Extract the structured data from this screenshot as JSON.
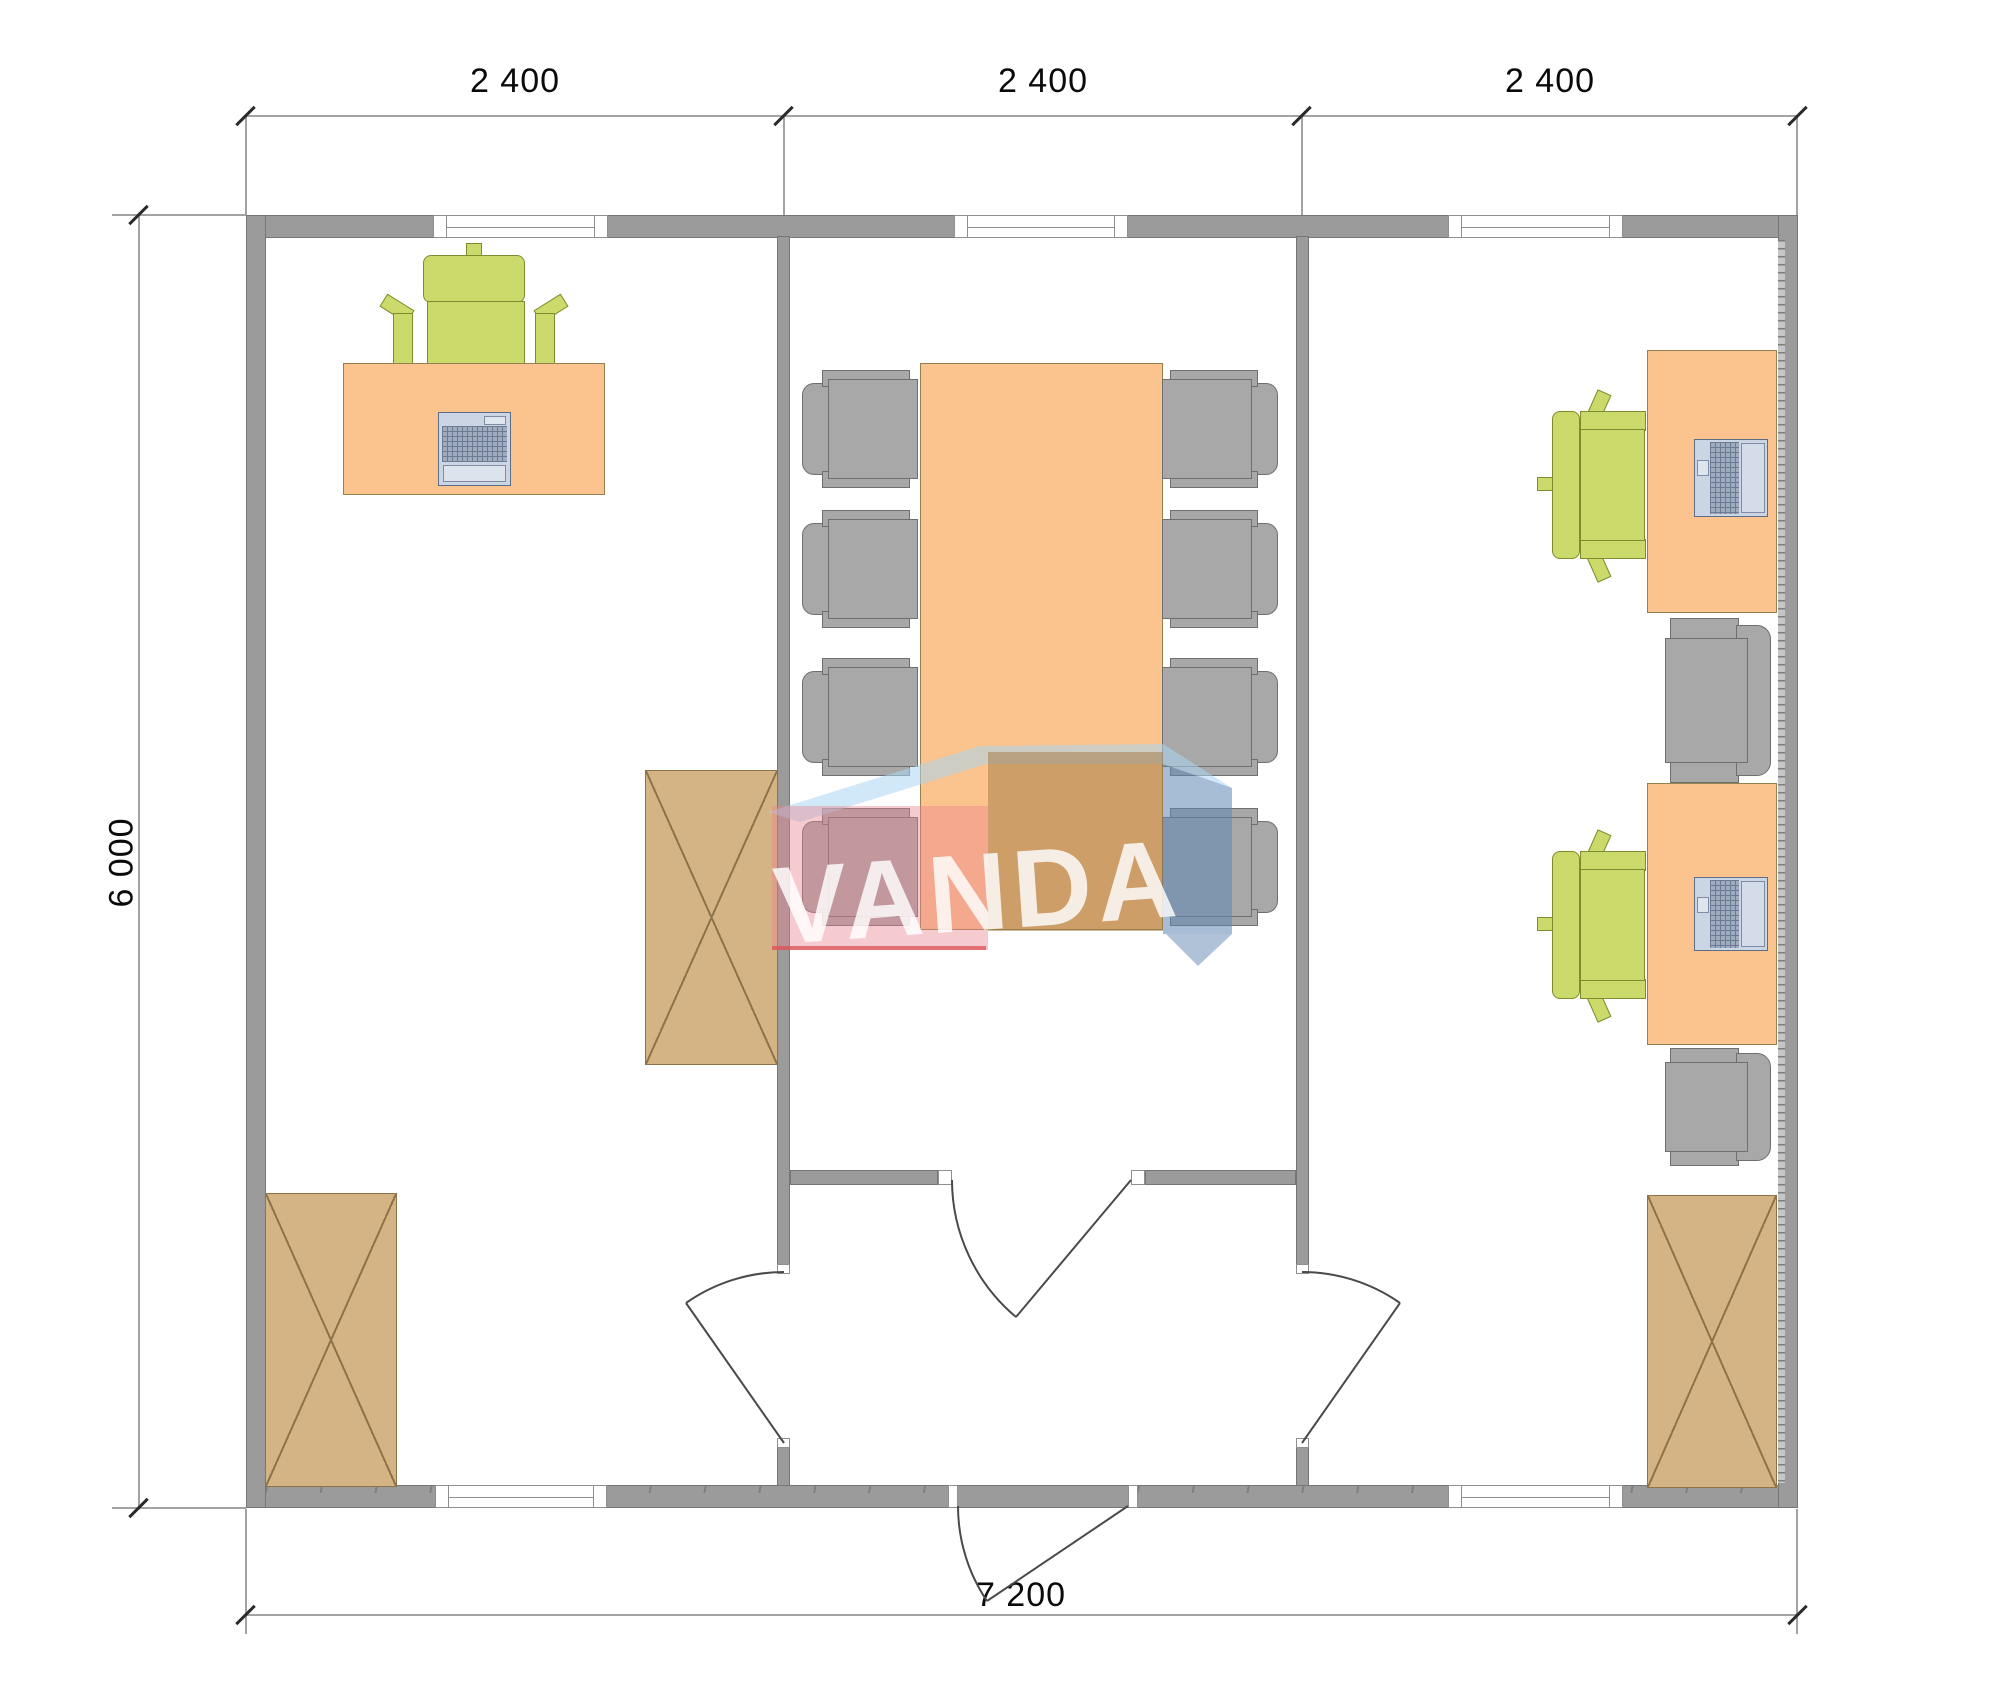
{
  "page": {
    "type": "architectural floor plan drawing",
    "background": "#ffffff"
  },
  "dimensions": {
    "top": {
      "labels": [
        "2 400",
        "2 400",
        "2 400"
      ]
    },
    "left": {
      "label": "6 000"
    },
    "bottom": {
      "label": "7 200"
    }
  },
  "watermark": {
    "text": "VANDA",
    "colors": {
      "lid": "#aed9f2",
      "left_face": "#ef9aa6",
      "right_face": "#a0774b",
      "side": "#6088b2",
      "text": "#ffffff"
    }
  },
  "colors": {
    "wall": "#9b9b9b",
    "window": "#ffffff",
    "desk": "#fbc48e",
    "table": "#fbc48e",
    "chair_green": "#ccd96b",
    "chair_gray": "#a8a8a8",
    "cabinet": "#d4b384",
    "dimension_text": "#0a0a0a"
  },
  "rooms": {
    "left_office": {
      "furniture": [
        "desk with keyboard",
        "green office chair",
        "tall cabinet",
        "tall cabinet"
      ]
    },
    "meeting_room": {
      "furniture": [
        "conference table",
        "8 gray chairs"
      ]
    },
    "right_office": {
      "furniture": [
        "desk with laptop",
        "desk with laptop",
        "2 green office chairs",
        "2 gray chairs",
        "tall cabinet"
      ]
    },
    "entrance_hall": {
      "doors": [
        "door to left office",
        "door to meeting room",
        "door to right office",
        "entrance door"
      ]
    }
  }
}
